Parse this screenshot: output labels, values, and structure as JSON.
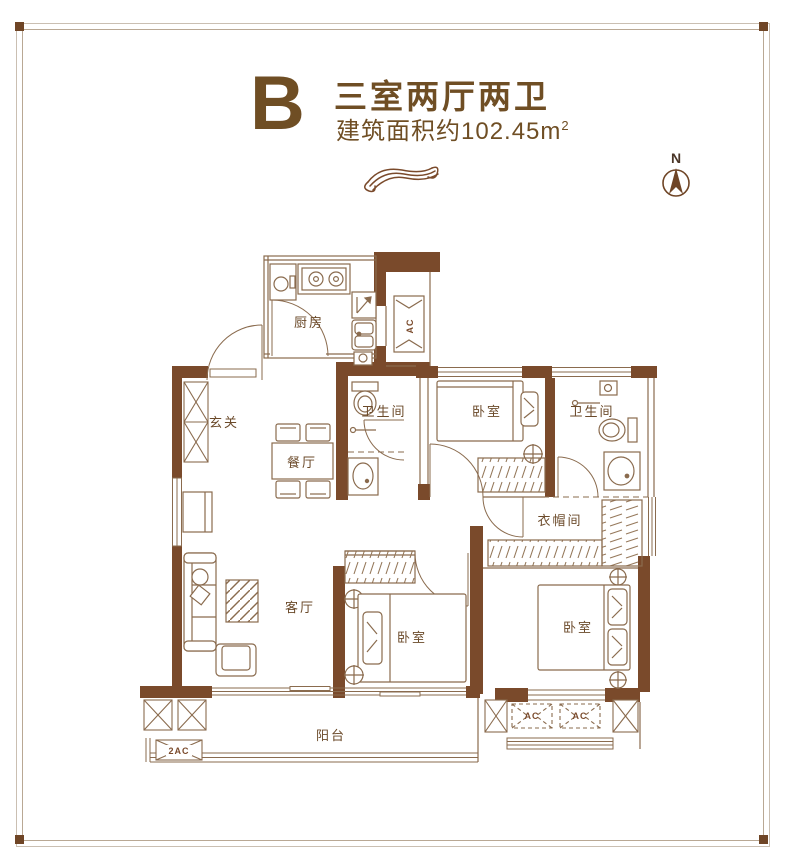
{
  "page": {
    "background": "#ffffff",
    "frame_color": "#cabfb2",
    "corner_color": "#6f4526"
  },
  "title": {
    "block_letter": "B",
    "headline": "三室两厅两卫",
    "subline": "建筑面积约102.45m",
    "subline_sup": "2",
    "color": "#6f4e24"
  },
  "compass": {
    "label": "N"
  },
  "plan": {
    "wall_color": "#7a4a2b",
    "line_color": "#8a6b4e",
    "label_color": "#6b4a2a",
    "rooms": [
      {
        "id": "kitchen",
        "label": "厨房"
      },
      {
        "id": "bath-1",
        "label": "卫生间"
      },
      {
        "id": "bedroom-1",
        "label": "卧室"
      },
      {
        "id": "bath-2",
        "label": "卫生间"
      },
      {
        "id": "foyer",
        "label": "玄关"
      },
      {
        "id": "dining",
        "label": "餐厅"
      },
      {
        "id": "cloakroom",
        "label": "衣帽间"
      },
      {
        "id": "living",
        "label": "客厅"
      },
      {
        "id": "bedroom-2",
        "label": "卧室"
      },
      {
        "id": "bedroom-3",
        "label": "卧室"
      },
      {
        "id": "balcony",
        "label": "阳台"
      }
    ],
    "ac_labels": {
      "kitchen_shaft": "AC",
      "balcony_unit": "2AC",
      "platform_1": "AC",
      "platform_2": "AC"
    }
  }
}
